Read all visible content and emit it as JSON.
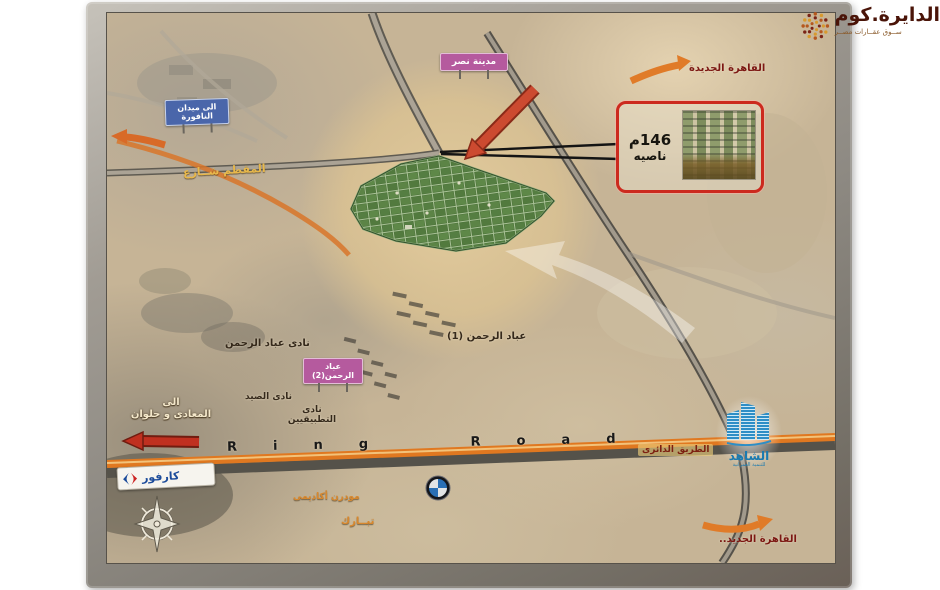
{
  "brand": {
    "title": "الدايرة.كوم",
    "subtitle": "ســوق  عقــارات  مصــر"
  },
  "labels": {
    "new_cairo_top": "القاهرة الجديدة",
    "nasr_city": "مدينة نصر",
    "to_nafoura_l1": "الى ميدان",
    "to_nafoura_l2": "النافورة",
    "mokattam_street": "المقطم شــارع",
    "ebad_elrahman_1": "عباد الرحمن (1)",
    "nadi_ebad_elrahman": "نادى عباد الرحمن",
    "ebad_elrahman_2_l1": "عباد",
    "ebad_elrahman_2_l2": "الرحمن(2)",
    "nadi_elsayd": "نادى الصيد",
    "nadi_tatbiqiyin_l1": "نادى",
    "nadi_tatbiqiyin_l2": "التطبيقيين",
    "to_maadi_l1": "الى",
    "to_maadi_l2": "المعادى و حلوان",
    "ring_road_en": "Ring Road",
    "ring_road_ar": "الطريق الدائرى",
    "modern_academy": "مودرن أكاديمى",
    "tabarak": "تبــارك",
    "new_cairo_bottom": "القاهرة الجديد..",
    "carrefour": "كارفور"
  },
  "inset": {
    "area": "146م",
    "corner": "ناصيه"
  },
  "shahed": {
    "name": "الشاهد",
    "subtitle": "للتنمية العمرانية"
  },
  "colors": {
    "accent_orange": "#e07820",
    "site_green": "#4a7038",
    "sign_pink": "#b55a9e",
    "sign_blue": "#4a66aa",
    "callout_red": "#cc2a1e",
    "brand_maroon": "#4a1408"
  }
}
